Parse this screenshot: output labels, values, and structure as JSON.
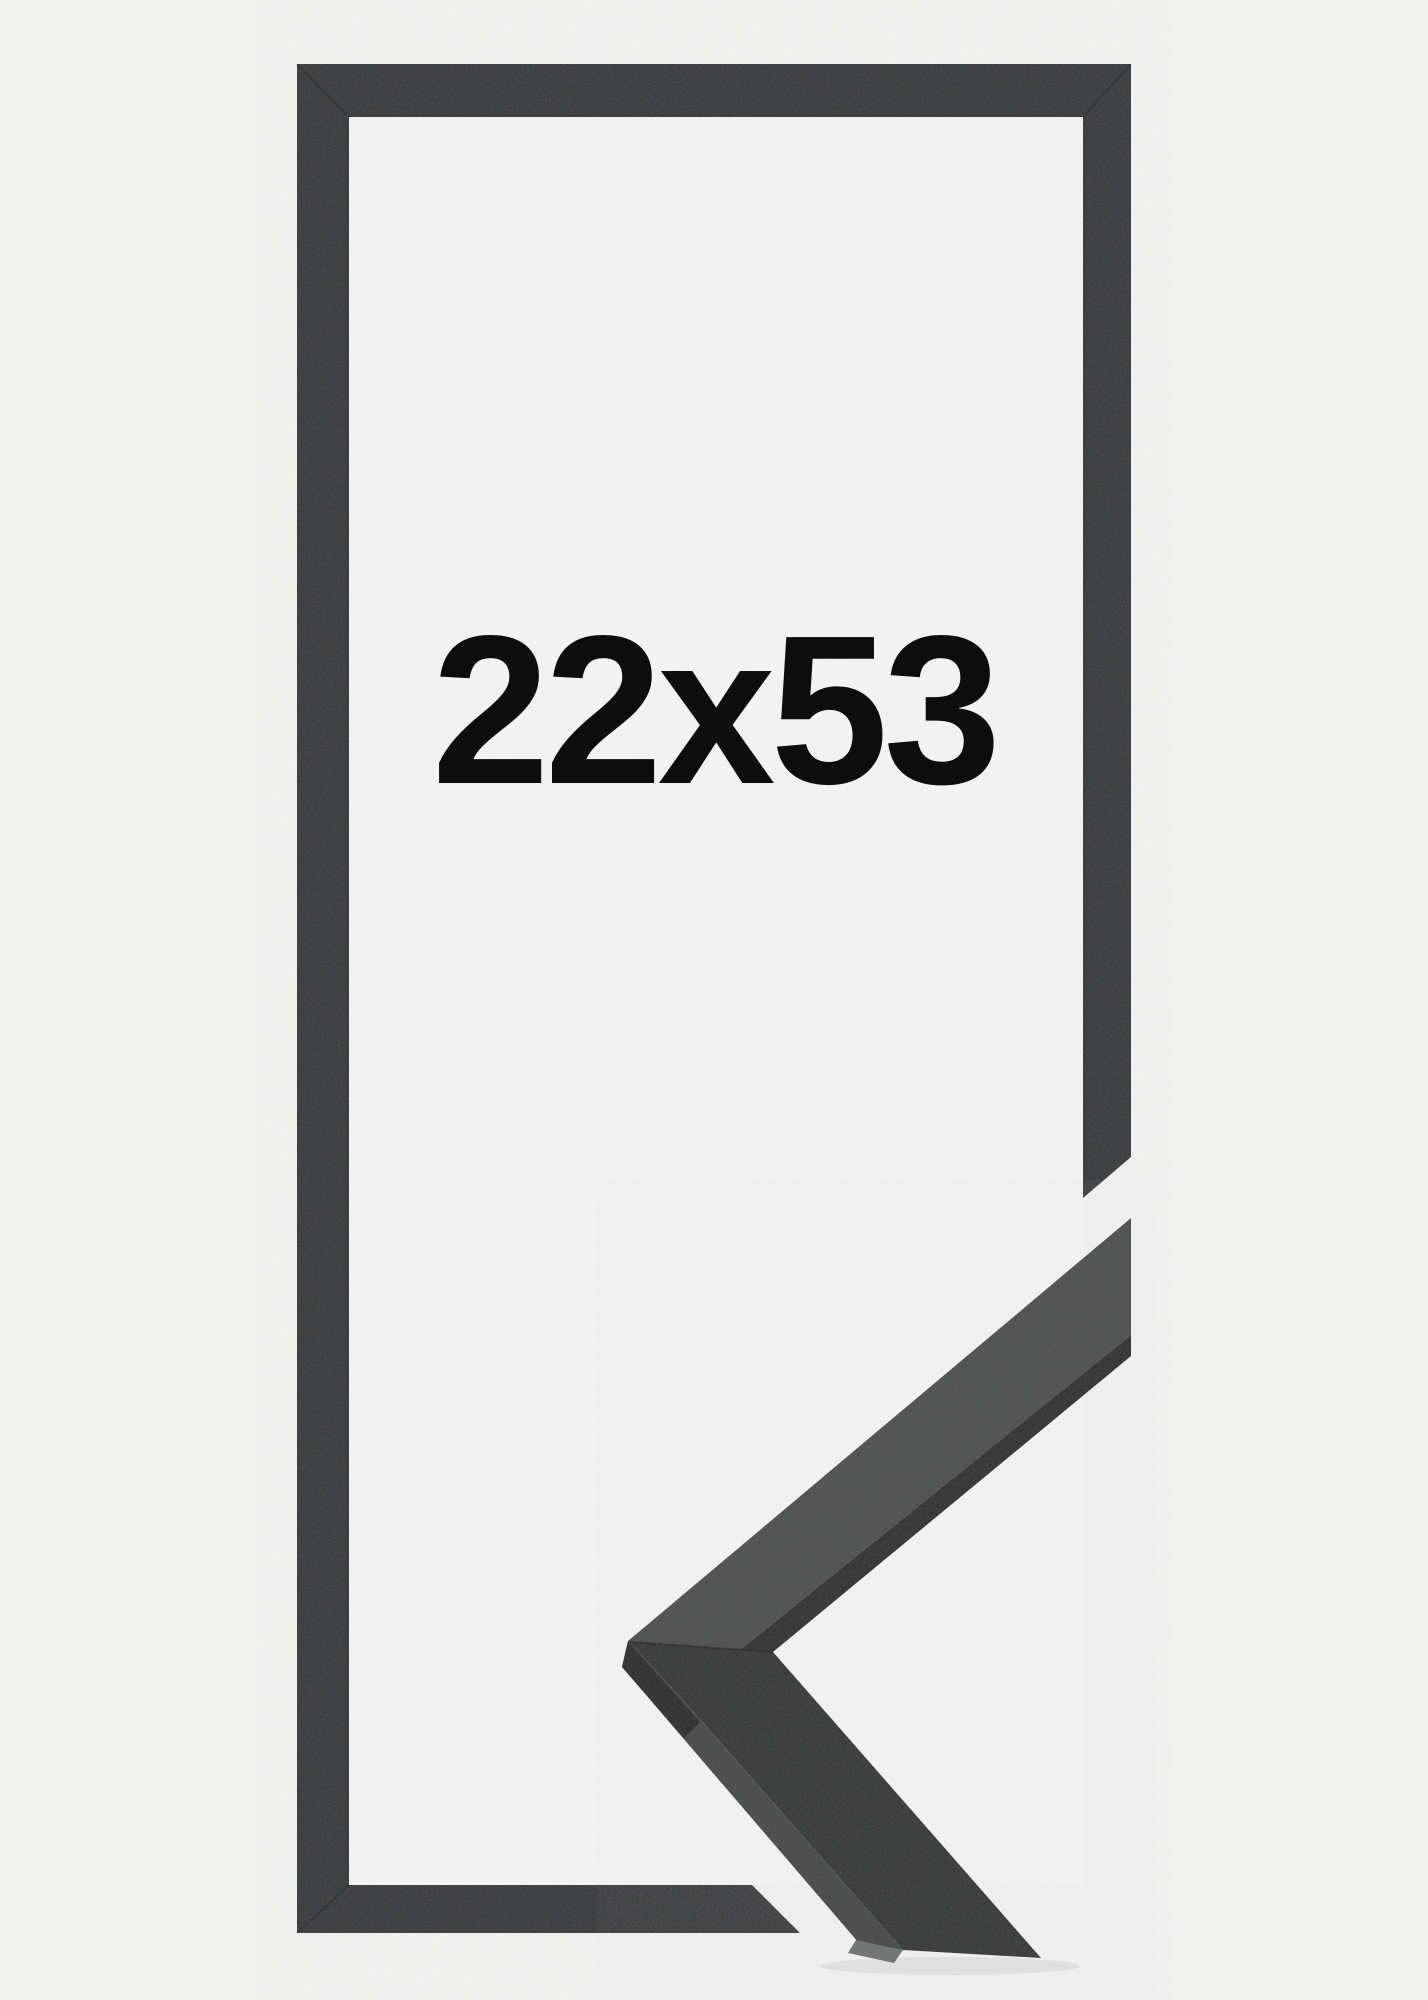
{
  "image": {
    "kind": "framed-product-photo",
    "size_label": "22x53"
  },
  "colors": {
    "background": "#f1f1f0",
    "opening": "#f4f4f3",
    "frame": "#343638",
    "label": "#0d0d0d",
    "sample_top_surface": "#4b4d4e",
    "sample_front_edge": "#2a2b2c",
    "sample_lower_face": "#323435",
    "sample_side_face": "#454748",
    "sample_end_face": "#6f7172",
    "sample_corner_face": "#252627",
    "seam": "rgba(0,0,0,0.28)",
    "seam_soft": "rgba(0,0,0,0.14)",
    "shadow": "rgba(0,0,0,0.06)"
  }
}
